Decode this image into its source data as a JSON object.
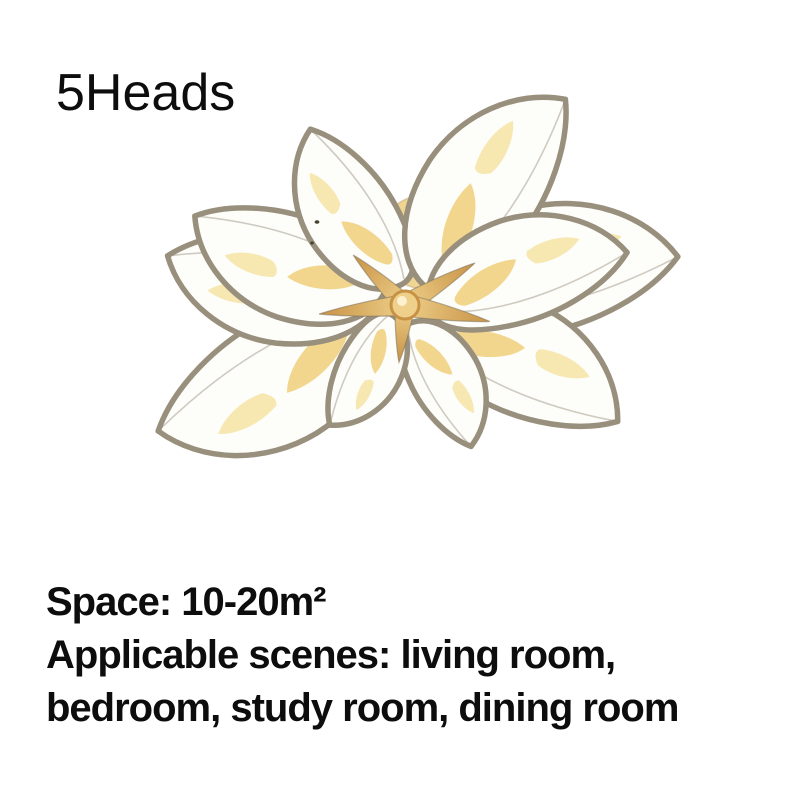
{
  "product": {
    "heads_label": "5Heads"
  },
  "specs": {
    "space": "Space: 10-20m²",
    "scenes_line1": "Applicable scenes: living room,",
    "scenes_line2": "bedroom, study room, dining room"
  },
  "image": {
    "name": "flower-ceiling-lamp",
    "heads_count": 5,
    "colors": {
      "petal_outline": "#998f7d",
      "petal_fill": "#fdfdfa",
      "accent_gold": "#f1d488",
      "accent_gold_light": "#f7e7ae",
      "hub_gold": "#c89245",
      "hub_gold_light": "#eed08a",
      "canopy_gold": "#f0d492",
      "text_color": "#0d0d0d",
      "background": "#ffffff"
    }
  }
}
